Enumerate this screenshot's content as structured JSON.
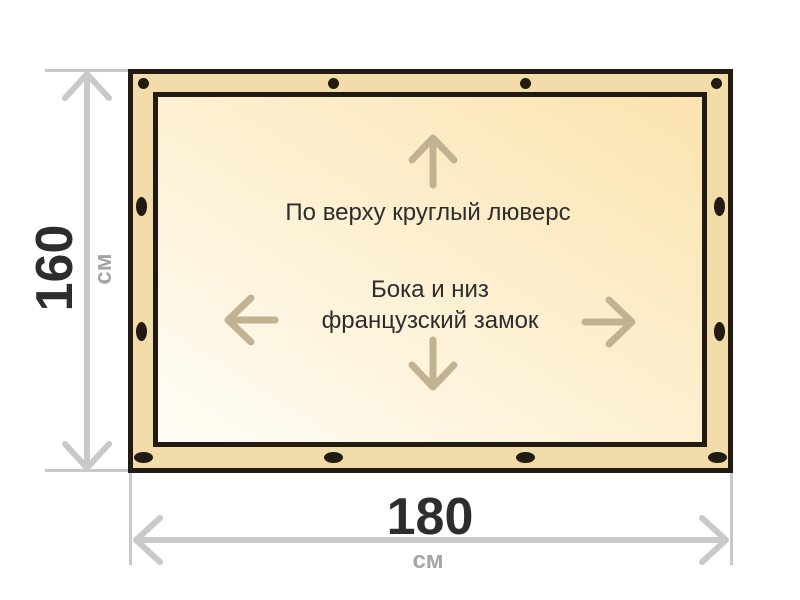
{
  "colors": {
    "canvas-bg": "#ffffff",
    "tarp-band": "#f2ddaa",
    "tarp-outline": "#211b14",
    "inner-grad-light": "#fffdf6",
    "inner-grad-dark": "#fbe3ae",
    "grommet-black": "#221b14",
    "arrow-tan": "#c1b292",
    "dim-line-gray": "#c9c9c9",
    "unit-gray": "#a5a5a5",
    "text-dark": "#2d2d2d"
  },
  "dimensions": {
    "height": {
      "value": "160",
      "unit": "см"
    },
    "width": {
      "value": "180",
      "unit": "см"
    }
  },
  "annotations": {
    "top_note": "По верху круглый люверс",
    "middle_note_line1": "Бока и низ",
    "middle_note_line2": "французский замок"
  },
  "fasteners": {
    "top_round_grommets": 4,
    "left_lock_slots": 2,
    "right_lock_slots": 2,
    "bottom_lock_slots": 4
  }
}
